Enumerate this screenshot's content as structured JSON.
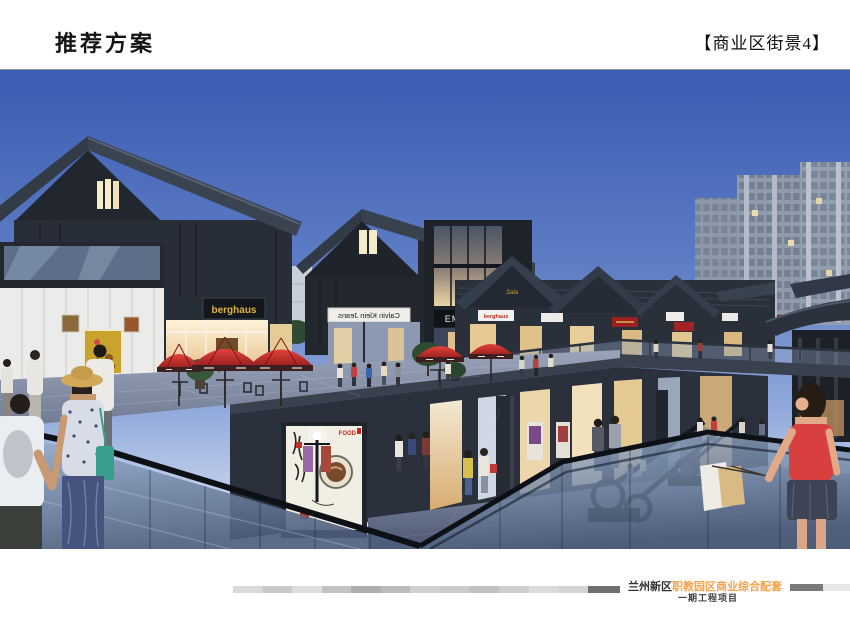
{
  "slide": {
    "title": "推荐方案",
    "view_label": "【商业区街景4】"
  },
  "footer": {
    "project_name_prefix": "兰州新区",
    "project_name_highlight": "职教园区商业综合配套",
    "project_phase": "一期工程项目"
  },
  "rendering": {
    "description": "商业区街景夜景效果图：日式坡屋顶商业街、红色遮阳伞、下沉广场玻璃栏板、扶梯与行人",
    "signs": {
      "berghaus_main": "berghaus",
      "calvin_klein": "Calvin Klein Jeans",
      "emag": "EMAG",
      "emag_number": "32",
      "berghaus_small": "berghaus",
      "sala_script": "Sala",
      "food_poster": "FOOD"
    },
    "colors": {
      "sky_top": "#3c5fb6",
      "sky_horizon": "#e4eaf5",
      "umbrella_red": "#c62828",
      "sign_gold": "#e0b23e",
      "accent_orange": "#f5a24d",
      "roof_dark": "#323b48",
      "warm_light": "#f2dfae"
    }
  }
}
